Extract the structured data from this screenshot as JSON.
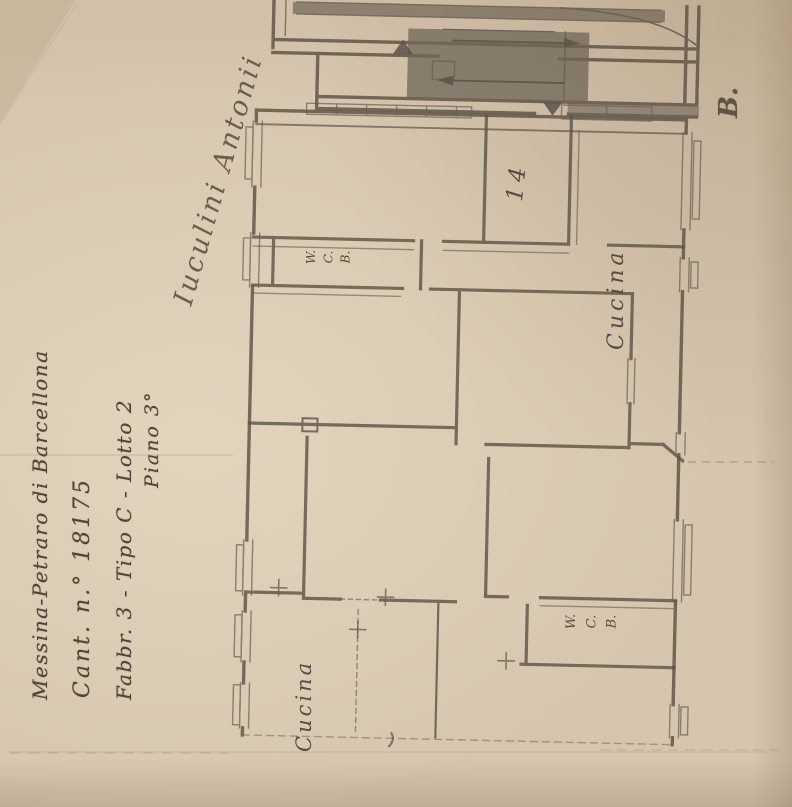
{
  "paper": {
    "header_lines": [
      "Messina-Petraro di Barcellona",
      "Cant. n.° 18175",
      "Fabbr. 3 - Tipo C - Lotto 2",
      "Piano 3°"
    ],
    "signature": "Iuculini Antonii",
    "corner_letter": "B."
  },
  "plan": {
    "room_labels": {
      "corridor_number": "14",
      "kitchen_top": "Cucina",
      "kitchen_bottom": "Cucina",
      "wc_top": [
        "W.",
        "C.",
        "B."
      ],
      "wc_bottom": [
        "W.",
        "C.",
        "B."
      ]
    }
  },
  "colors": {
    "paper": "#d6c6ae",
    "plan_ink": "#5b5347",
    "pencil": "#4e4539"
  }
}
